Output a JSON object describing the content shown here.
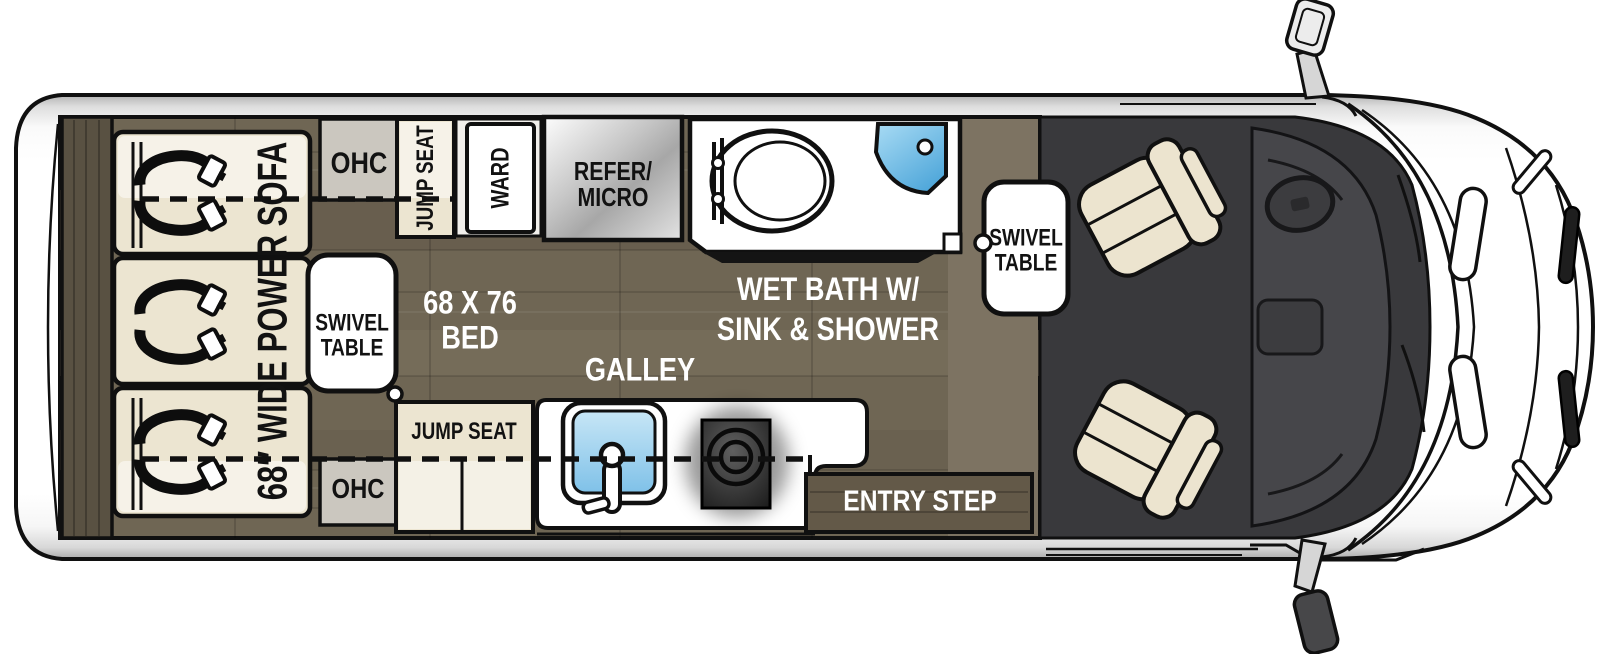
{
  "floorplan": {
    "type": "rv-class-b-van-floorplan-top-view",
    "labels": {
      "sofa": "68″ WIDE POWER SOFA",
      "ohc_top": "OHC",
      "ohc_bottom": "OHC",
      "swivel_table_rear": "SWIVEL\nTABLE",
      "swivel_table_cab": "SWIVEL\nTABLE",
      "jump_seat_top": "JUMP SEAT",
      "jump_seat_bottom": "JUMP SEAT",
      "ward": "WARD",
      "refer_micro": "REFER/\nMICRO",
      "bed": "68 X 76\nBED",
      "galley": "GALLEY",
      "wet_bath": "WET BATH W/\nSINK & SHOWER",
      "entry_step": "ENTRY STEP"
    },
    "colors": {
      "outline": "#101010",
      "body_white": "#ffffff",
      "floor_wood": "#6f6654",
      "floor_wood_light": "#7d7362",
      "rear_cabinet_wood": "#595142",
      "entry_step_wood": "#635948",
      "cushion_cream": "#ece5d1",
      "cabinet_gray": "#cbc7bf",
      "refer_metal": "#bfbfbf",
      "shower_blue": "#58aede",
      "sink_blue": "#85c6ea",
      "cab_floor_dark": "#39393c",
      "dashboard_gray": "#46464a"
    }
  }
}
